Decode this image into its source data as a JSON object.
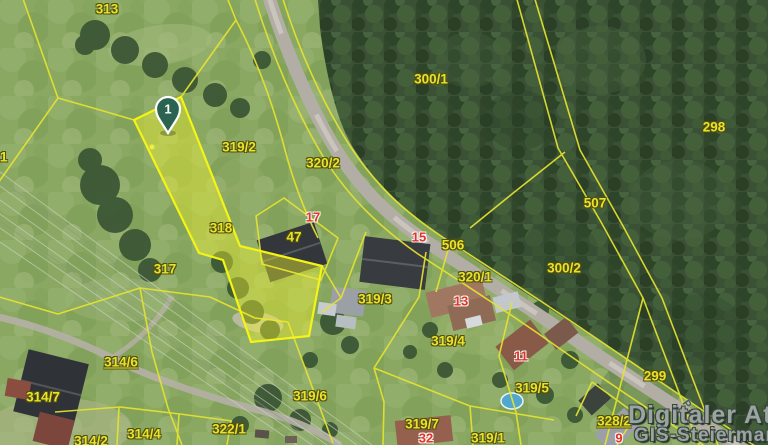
{
  "map": {
    "title_watermark": {
      "line1": "Digitaler Atla",
      "line2": "GIS-Steiermark"
    },
    "marker": {
      "label": "1"
    },
    "street_label": "Pau",
    "selected_parcel": "318",
    "parcels": [
      {
        "label": "313"
      },
      {
        "label": "319/2"
      },
      {
        "label": "320/2"
      },
      {
        "label": "300/1"
      },
      {
        "label": "298"
      },
      {
        "label": "507"
      },
      {
        "label": "300/2"
      },
      {
        "label": "506"
      },
      {
        "label": "320/1"
      },
      {
        "label": "318"
      },
      {
        "label": "317"
      },
      {
        "label": "1"
      },
      {
        "label": "319/3"
      },
      {
        "label": "319/4"
      },
      {
        "label": "314/6",
        "linked": true
      },
      {
        "label": "314/7"
      },
      {
        "label": "319/6"
      },
      {
        "label": "322/1"
      },
      {
        "label": "314/2"
      },
      {
        "label": "314/4"
      },
      {
        "label": "319/7"
      },
      {
        "label": "319/1"
      },
      {
        "label": "319/5"
      },
      {
        "label": "299"
      },
      {
        "label": "328/2",
        "linked": true
      },
      {
        "label": "47"
      }
    ],
    "houses": [
      {
        "number": "17"
      },
      {
        "number": "15"
      },
      {
        "number": "13"
      },
      {
        "number": "11"
      },
      {
        "number": "32"
      },
      {
        "number": "9"
      }
    ],
    "colors": {
      "boundary_yellow": "#e6e32f",
      "selected_stroke": "#f4f415",
      "selected_fill_rgba": "rgba(243,243,46,0.42)",
      "parcel_label": "#e6e32f",
      "house_label": "#e23429",
      "marker_green": "#2a6350",
      "watermark_gray": "#9aa4a0",
      "road_gray": "#b3aea5",
      "grass_green": "#8aa862",
      "forest_green": "#3a5136",
      "pool_blue": "#52a8cc"
    }
  }
}
